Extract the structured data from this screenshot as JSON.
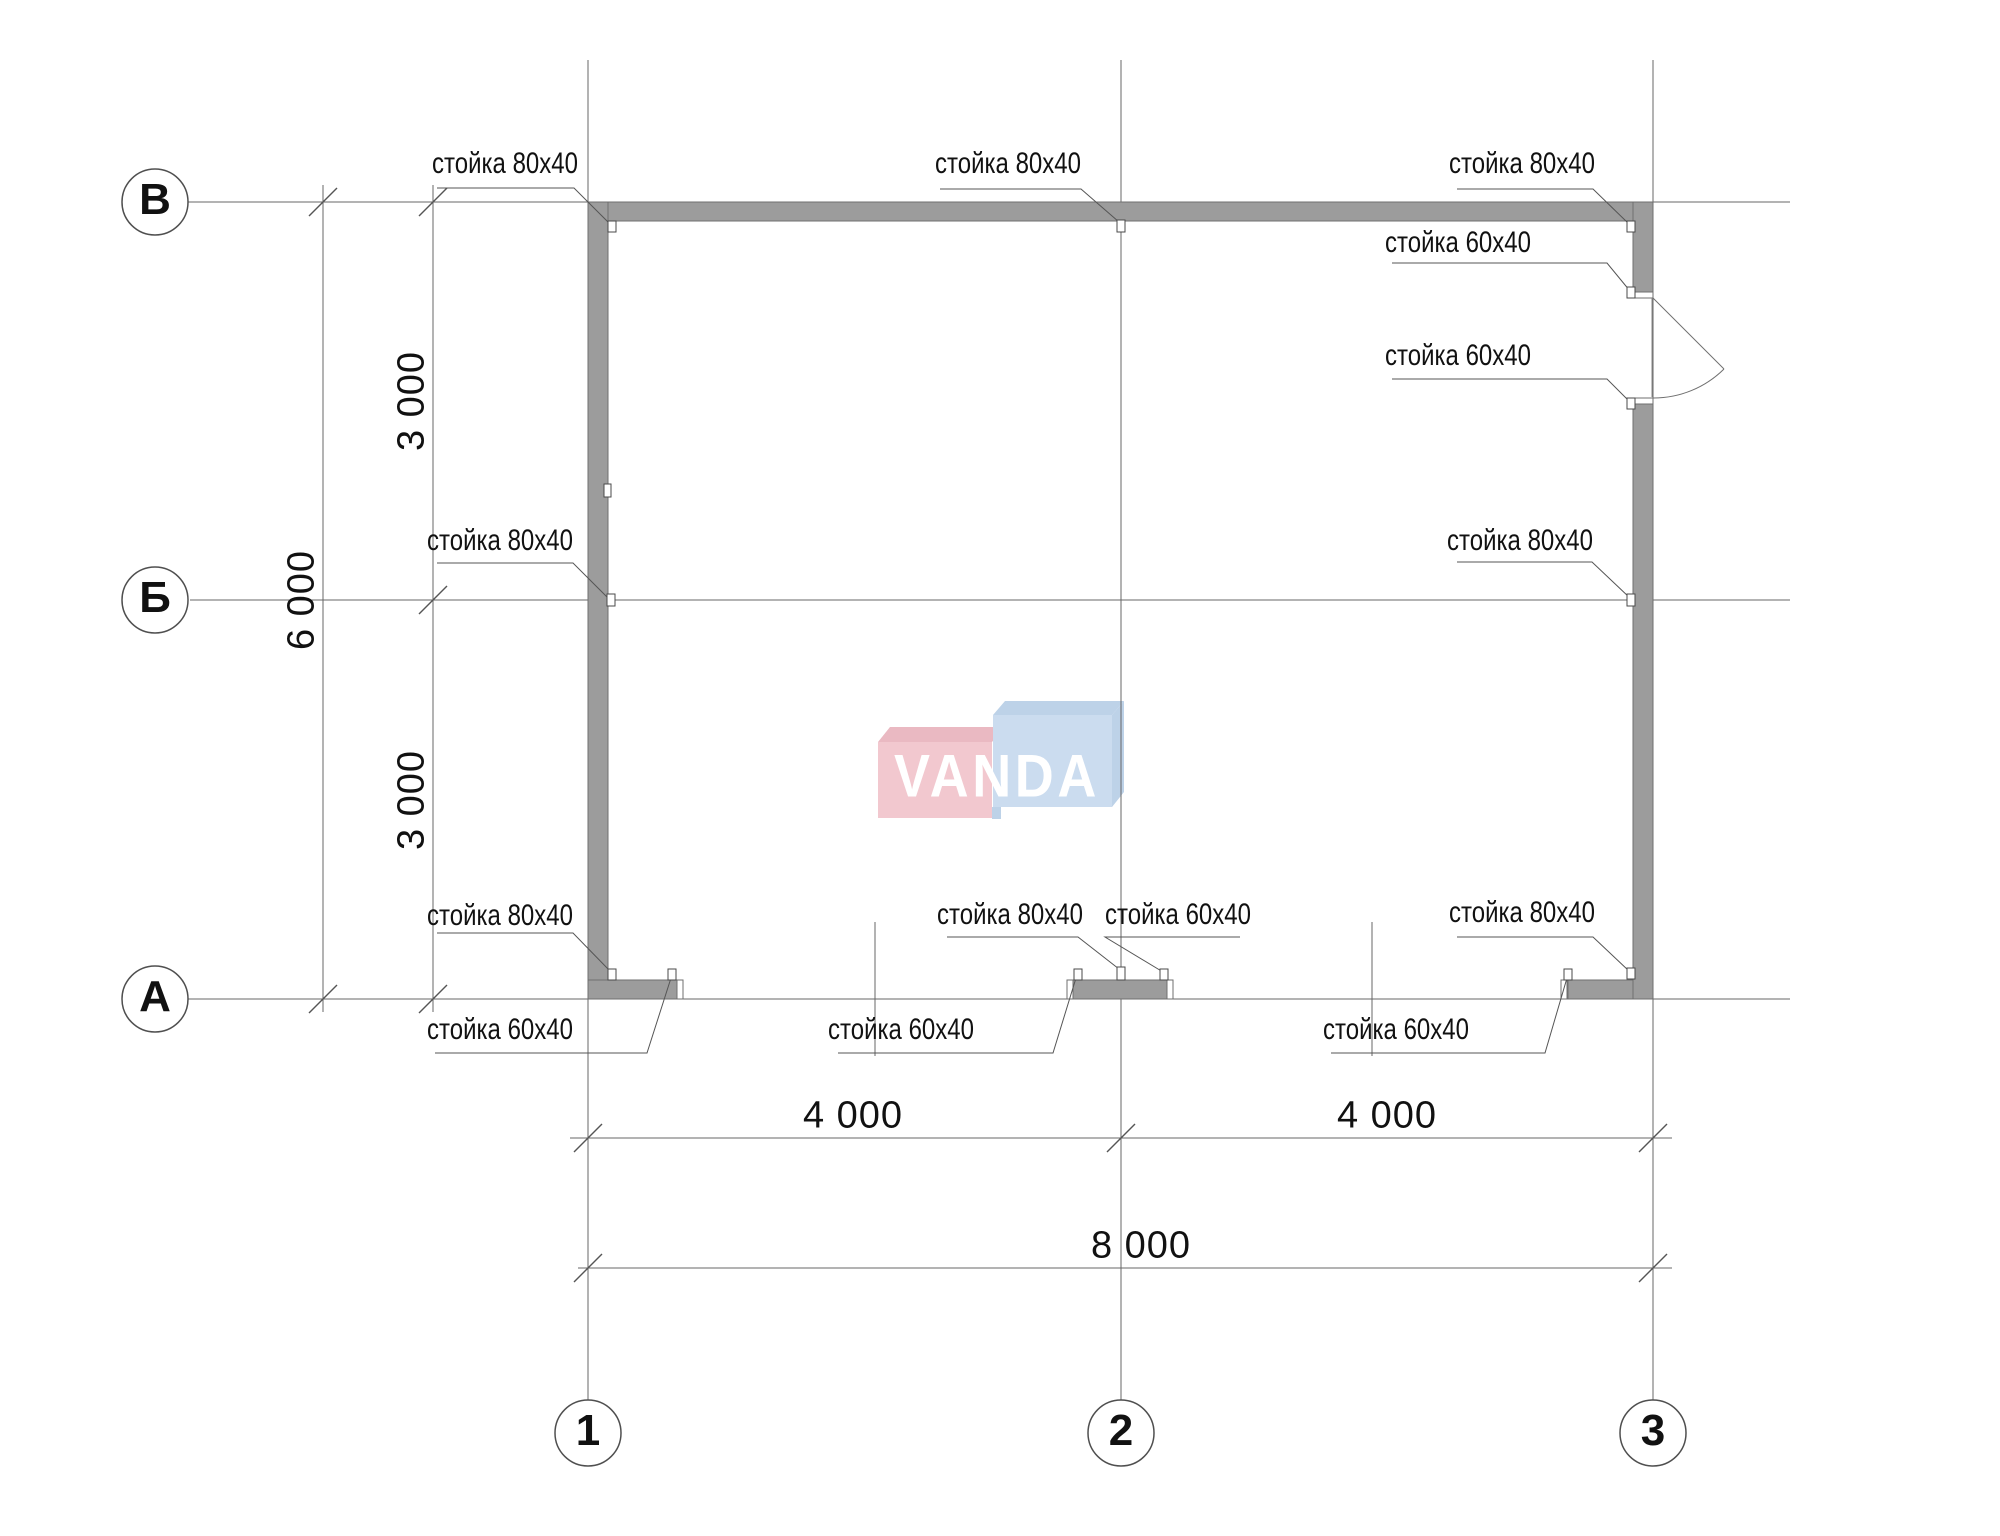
{
  "plan": {
    "axes": {
      "rows": [
        {
          "label": "В"
        },
        {
          "label": "Б"
        },
        {
          "label": "А"
        }
      ],
      "cols": [
        {
          "label": "1"
        },
        {
          "label": "2"
        },
        {
          "label": "3"
        }
      ]
    },
    "post_labels": {
      "post_80x40": "стойка 80x40",
      "post_60x40": "стойка 60x40"
    },
    "dimensions": {
      "vertical_upper": "3 000",
      "vertical_lower": "3 000",
      "vertical_total": "6 000",
      "horizontal_left": "4 000",
      "horizontal_right": "4 000",
      "horizontal_total": "8 000"
    },
    "watermark": {
      "text": "VANDA"
    },
    "colors": {
      "wall_fill": "#9c9c9c",
      "wall_edge": "#6f6f6f",
      "line": "#676767",
      "text": "#111111",
      "watermark_pink": "#f2c8cf",
      "watermark_pink_dark": "#eab9c2",
      "watermark_blue": "#cbdcef",
      "watermark_blue_dark": "#bdd2e8",
      "watermark_text": "#ffffff"
    }
  }
}
